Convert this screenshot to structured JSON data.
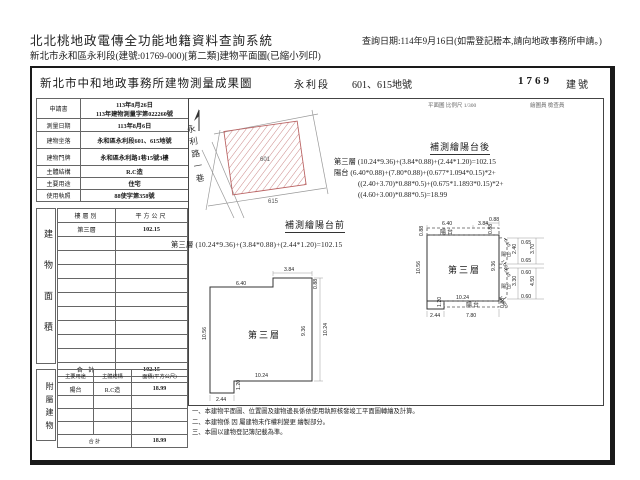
{
  "app": {
    "title": "北北桃地政電傳全功能地籍資料查詢系統",
    "subtitle": "新北市永和區永利段(建號:01769-000)[第二類]建物平面圖(已縮小列印)",
    "query_date": "查詢日期:114年9月16日(如需登記謄本,請向地政事務所申請。)"
  },
  "doc": {
    "office": "新北市中和地政事務所建物測量成果圖",
    "section": "永利段",
    "parcel": "601、615地號",
    "building_no": "1769",
    "building_no_label": "建號",
    "scale_note": "平面圖 比例尺 1/300",
    "stamp_note": "繪圖員  檢查員"
  },
  "info": {
    "rows": [
      {
        "label": "申請書",
        "v1": "113年8月26日",
        "v2": "113年建物測量字第022260號"
      },
      {
        "label": "測量日期",
        "v1": "113年8月6日"
      },
      {
        "label": "建物坐落",
        "v1": "永和區永利段601、615地號"
      },
      {
        "label": "建物門牌",
        "v1": "永和區永利路1巷15號3樓"
      },
      {
        "label": "主體結構",
        "v1": "R.C造"
      },
      {
        "label": "主要用途",
        "v1": "住宅"
      },
      {
        "label": "使用執照",
        "v1": "88使字第358號"
      }
    ]
  },
  "floor": {
    "vertical": "建物面積",
    "col1": "樓層別",
    "col2": "平方公尺",
    "row_label": "第三層",
    "row_value": "102.15",
    "total_label": "合  計",
    "total_value": "102.15"
  },
  "annex": {
    "vertical": "附屬建物",
    "col1": "主要用途",
    "col2": "主體結構",
    "col3": "面積(平方公尺)",
    "row1": "陽台",
    "row2": "R.C造",
    "row3": "18.99",
    "total_label": "合  計",
    "total_value": "18.99"
  },
  "site": {
    "street": "永利路一巷",
    "lot_main": "601",
    "lot_side": "615"
  },
  "before": {
    "title": "補測繪陽台前",
    "formula": "第三層 (10.24*9.36)+(3.84*0.88)+(2.44*1.20)=102.15",
    "room": "第三層",
    "dims": {
      "top": "6.40",
      "bump": "3.84",
      "bump_h": "0.88",
      "left": "10.56",
      "right_in": "9.36",
      "right_out": "10.24",
      "bottom": "10.24",
      "notch_w": "2.44",
      "notch_h": "1.20"
    }
  },
  "after": {
    "title": "補測繪陽台後",
    "f1": "第三層 (10.24*9.36)+(3.84*0.88)+(2.44*1.20)=102.15",
    "f2": "陽台 (6.40*0.88)+(7.80*0.88)+(0.677*1.094*0.15)*2+",
    "f3": "((2.40+3.70)*0.88*0.5)+(0.675*1.1893*0.15)*2+",
    "f4": "((4.60+3.00)*0.88*0.5)=18.99",
    "room": "第三層",
    "balcony": "陽台",
    "dims": {
      "top": "6.40",
      "top2": "3.84",
      "top_small": "0.88",
      "strip_h": "0.88",
      "strip_mid": "0.88",
      "left": "10.56",
      "right": "9.36",
      "a1": "0.65",
      "a2": "2.40",
      "a3": "0.65",
      "a4": "3.70",
      "a5": "0.15",
      "a6": "1.094",
      "b1": "0.60",
      "b2": "3.30",
      "b3": "0.60",
      "b4": "4.50",
      "b5": "0.15",
      "b6": "1.1893",
      "bottom": "10.24",
      "strip_w": "7.80",
      "strip_h2": "0.88",
      "notch_w": "2.44",
      "notch_h": "1.20"
    }
  },
  "notes": [
    "一、本建物平面圖、位置圖及建物邊長係依使用執照核發竣工平面圖轉繪及計算。",
    "二、本建物係 因 屬建物未作權利變更 繪製部分。",
    "三、本圖以建物登記簿記載為準。"
  ]
}
